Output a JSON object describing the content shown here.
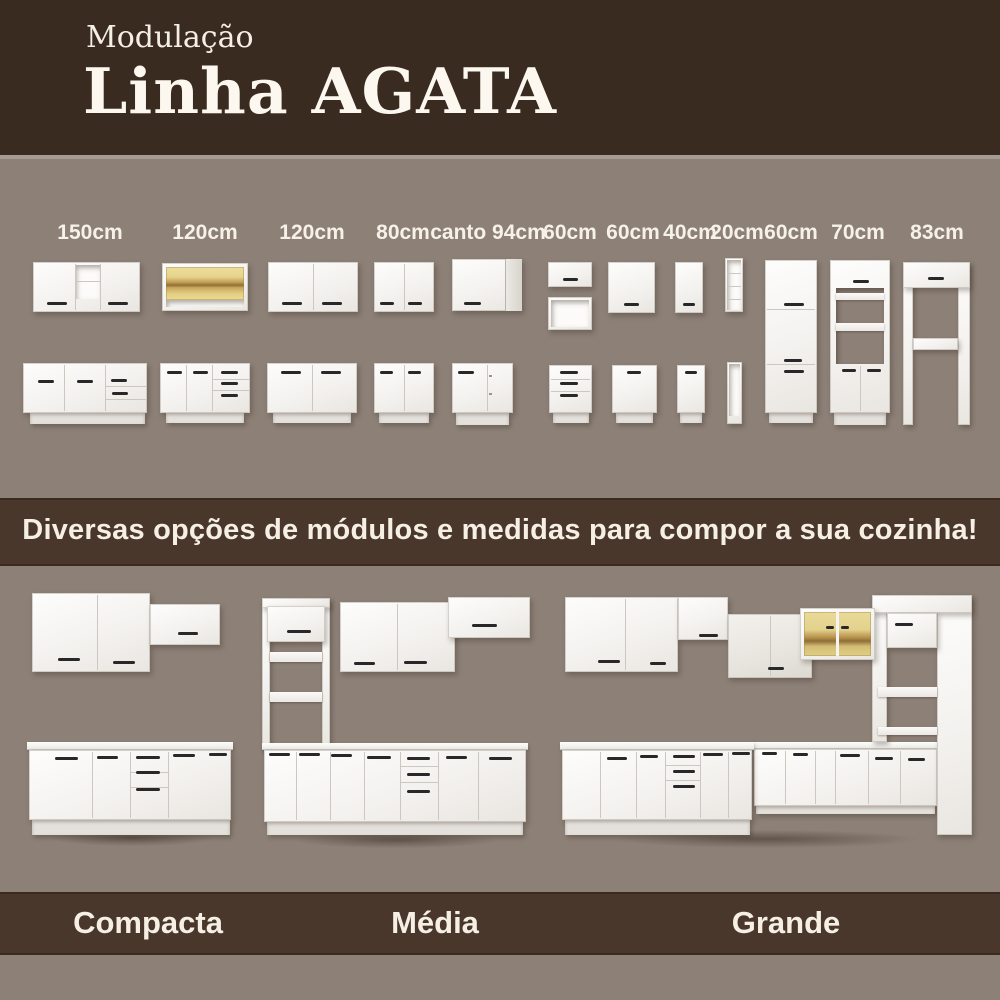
{
  "header": {
    "subtitle": "Modulação",
    "title": "Linha AGATA"
  },
  "modules": {
    "sizes": [
      "150cm",
      "120cm",
      "120cm",
      "80cm",
      "canto 94cm",
      "60cm",
      "60cm",
      "40cm",
      "20cm",
      "60cm",
      "70cm",
      "83cm"
    ]
  },
  "banner": {
    "text": "Diversas opções de módulos e medidas para compor a sua cozinha!"
  },
  "kitchens": {
    "items": [
      {
        "label": "Compacta"
      },
      {
        "label": "Média"
      },
      {
        "label": "Grande"
      }
    ]
  },
  "colors": {
    "header_bg": "#3a2b21",
    "band_bg": "#4a372c",
    "backdrop": "#8d8077",
    "cabinet_white": "#f6f4f1",
    "handle_dark": "#282828",
    "wood_tone": "#e4d28a",
    "text_light": "#f6efe4"
  }
}
